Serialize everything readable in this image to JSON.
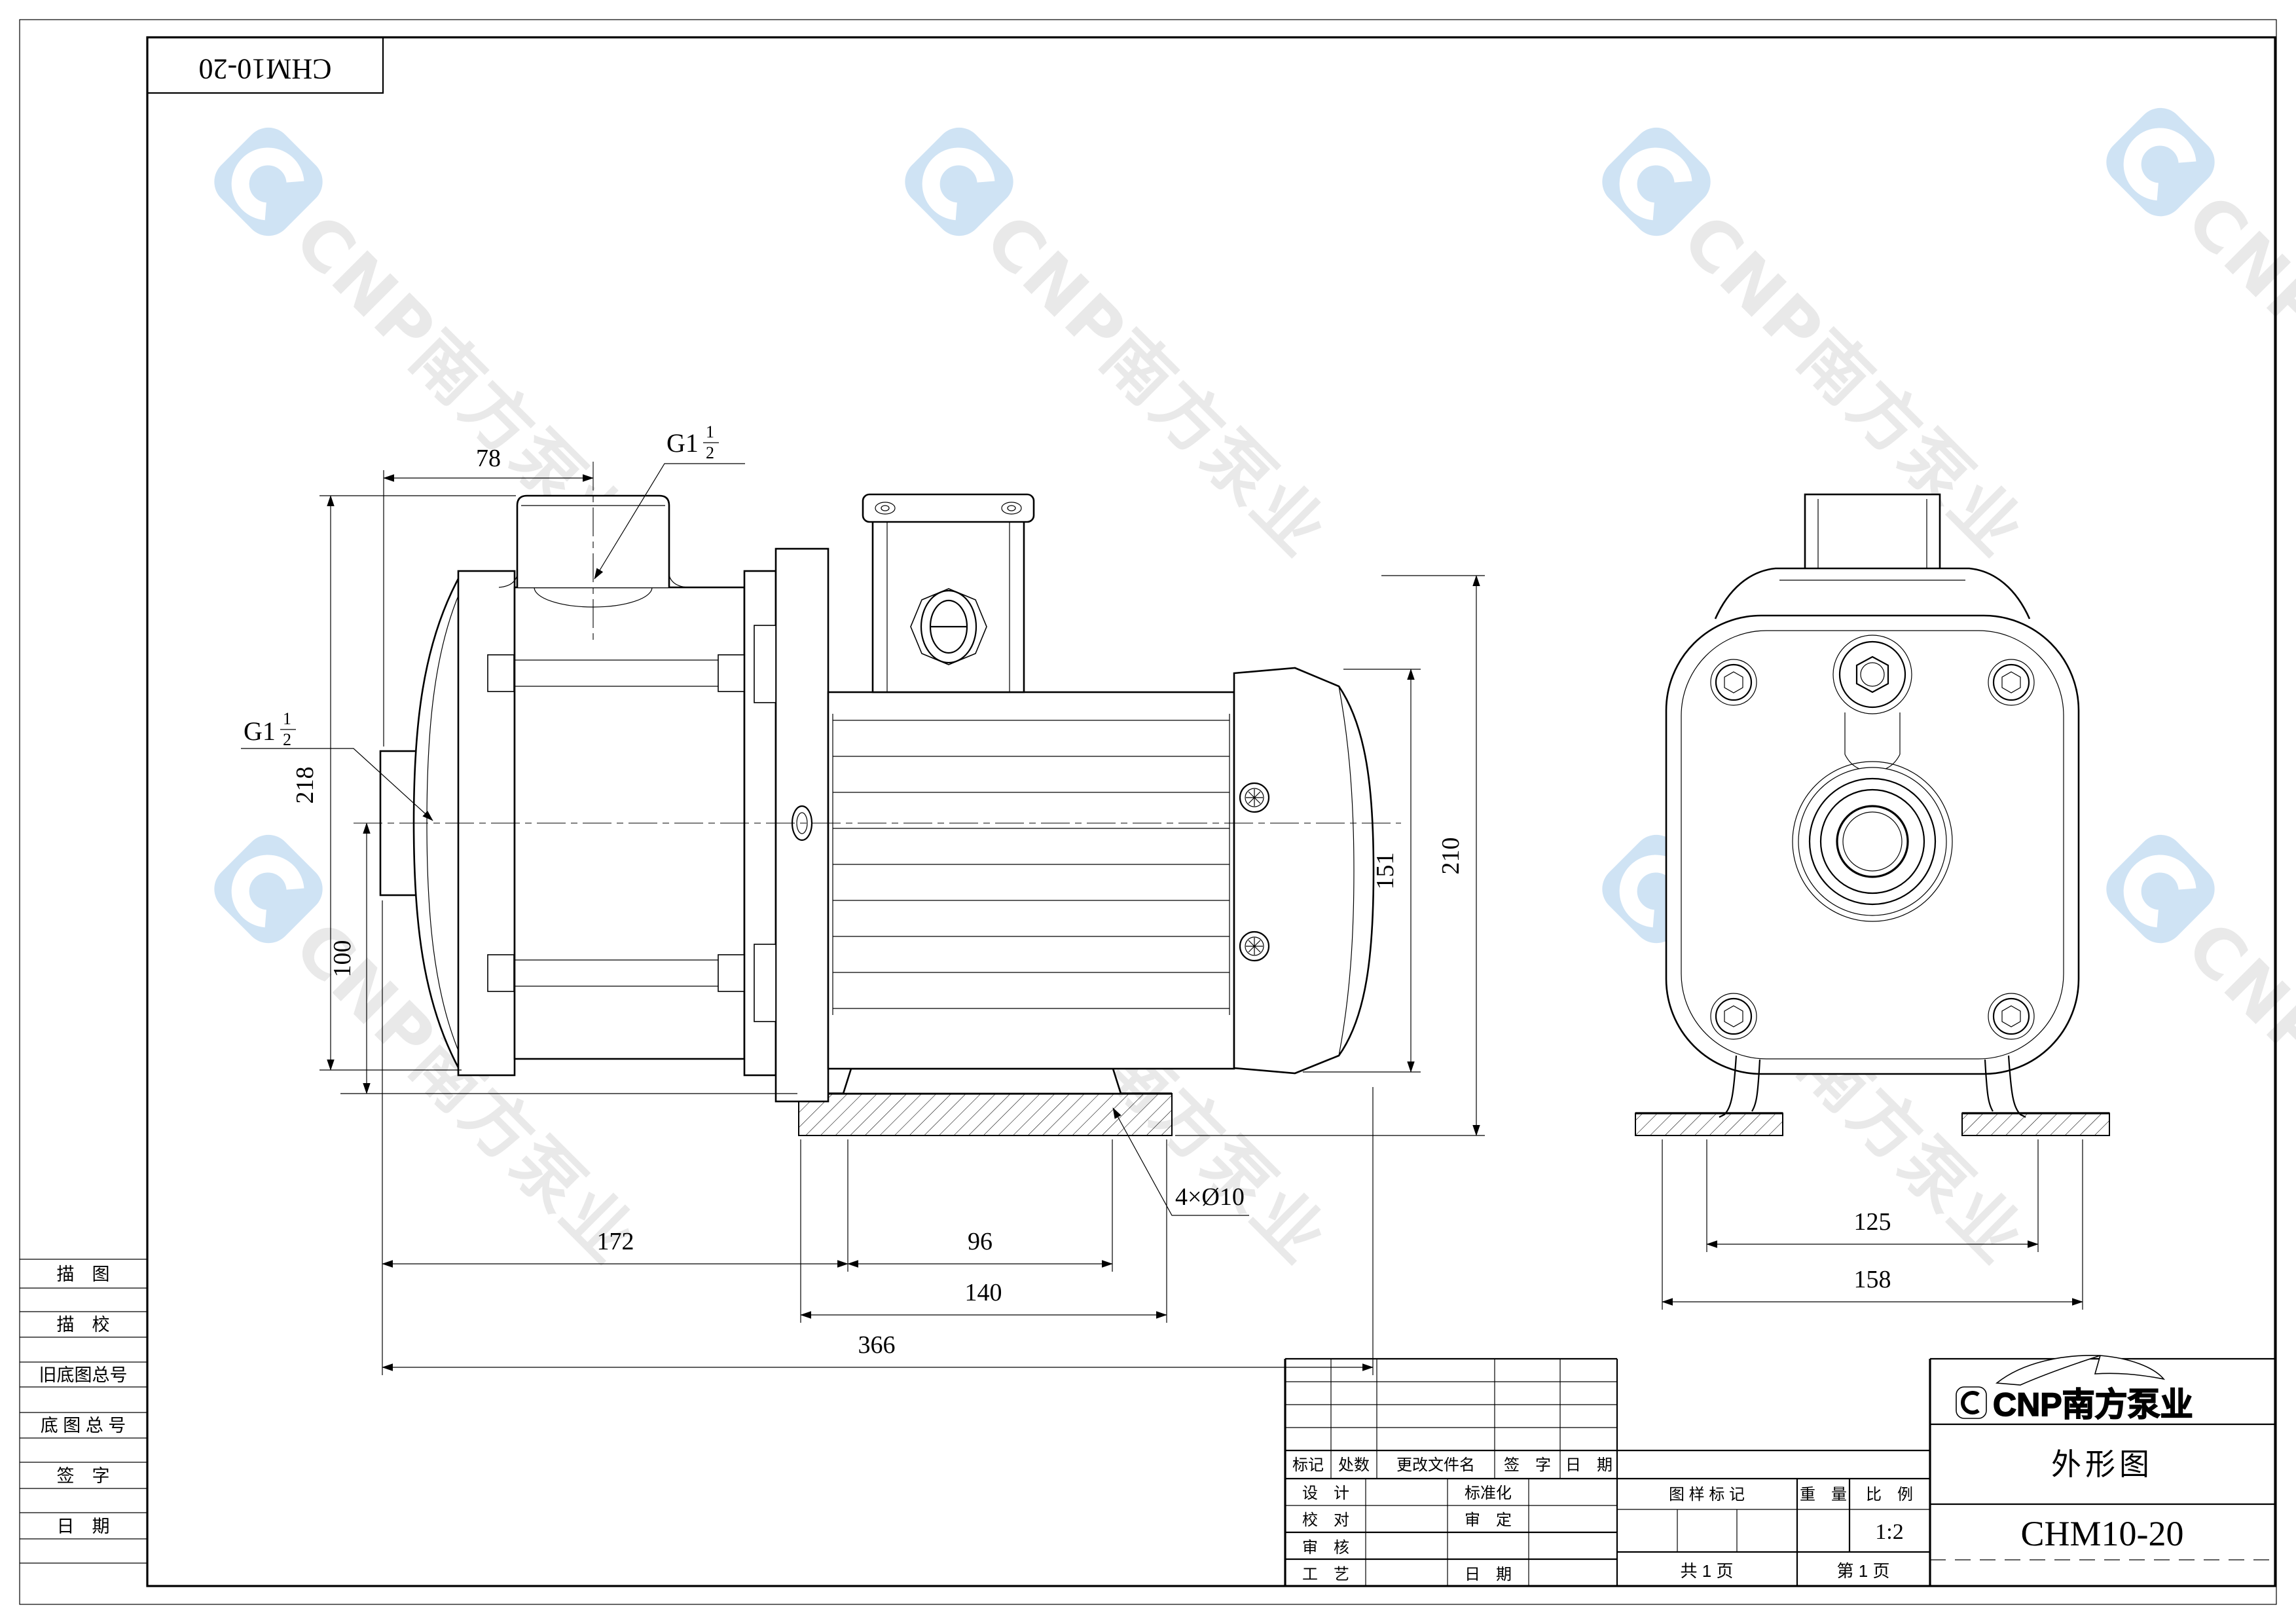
{
  "sheet": {
    "code_top_left": "CHM10-20"
  },
  "watermark": {
    "text": "CNP南方泵业",
    "glyph_color": "#cfe3f4",
    "text_color": "#e9e9e9"
  },
  "left_table": {
    "rows": [
      "描　图",
      "描　校",
      "旧底图总号",
      "底 图 总 号",
      "签　字",
      "日　期"
    ]
  },
  "drawing": {
    "dims": {
      "d78": "78",
      "g_prefix": "G1",
      "g_num": "1",
      "g_den": "2",
      "d218": "218",
      "d100": "100",
      "d172": "172",
      "d96": "96",
      "d140": "140",
      "d366": "366",
      "holes": "4×Ø10",
      "d151": "151",
      "d210": "210",
      "d125": "125",
      "d158": "158"
    }
  },
  "title_block": {
    "revision_header": {
      "mark": "标记",
      "count": "处数",
      "file": "更改文件名",
      "sign": "签　字",
      "date": "日　期"
    },
    "form": {
      "design": "设　计",
      "check": "校　对",
      "review": "审　核",
      "process": "工　艺",
      "standard": "标准化",
      "approve": "审　定",
      "date": "日　期"
    },
    "stamp": {
      "mark_header": "图 样 标 记",
      "weight_header": "重　量",
      "scale_header": "比　例",
      "scale_value": "1:2",
      "total_pages": "共 1 页",
      "page_no": "第 1 页"
    },
    "brand": {
      "text": "CNP南方泵业"
    },
    "doc_title": "外形图",
    "model": "CHM10-20"
  }
}
